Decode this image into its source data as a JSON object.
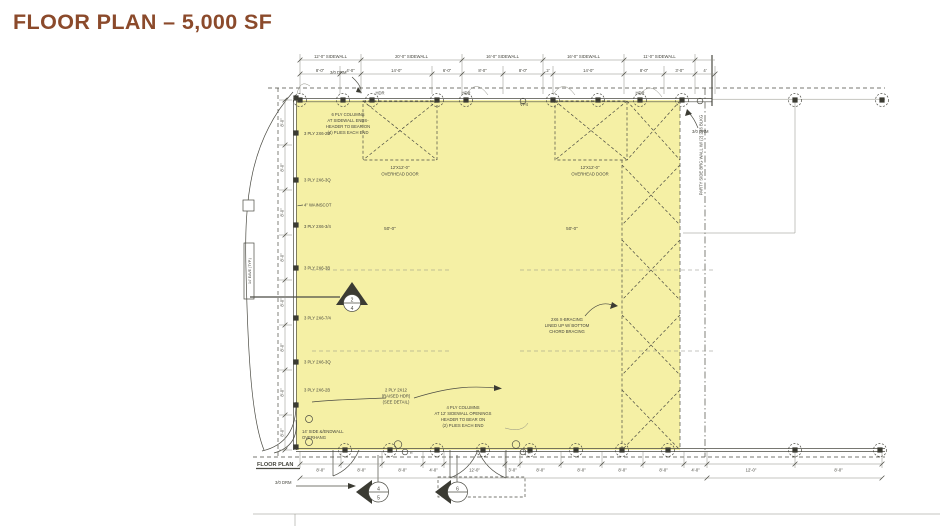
{
  "title": "FLOOR PLAN – 5,000 SF",
  "colors": {
    "highlight": "#F4EF9D",
    "line": "#4B4B43",
    "title_brown": "#8B4A2B"
  },
  "plan": {
    "sheet_label": "FLOOR PLAN",
    "top_dims_upper": [
      "12'-0\" SIDEWALL",
      "20'-0\" SIDEWALL",
      "16'-0\" SIDEWALL",
      "16'-0\" SIDEWALL",
      "11'-0\" SIDEWALL"
    ],
    "top_dims": [
      "8'-0\"",
      "4'-0\"",
      "14'-0\"",
      "6'-0\"",
      "8'-0\"",
      "8'-0\"",
      "2'",
      "14'-0\"",
      "8'-0\"",
      "3'-0\"",
      "4'"
    ],
    "bottom_dims": [
      "8'-0\"",
      "8'-0\"",
      "8'-0\"",
      "4'-0\"",
      "12'-0\"",
      "3'-0\"",
      "8'-0\"",
      "8'-0\"",
      "8'-0\"",
      "8'-0\"",
      "4'-0\"",
      "12'-0\"",
      "8'-0\""
    ],
    "left_dims": [
      "8'-0\"",
      "8'-0\"",
      "8'-0\"",
      "8'-0\"",
      "8'-0\"",
      "8'-0\"",
      "8'-0\"",
      "8'-0\""
    ],
    "bay_labels": [
      "50'-0\"",
      "50'-0\""
    ],
    "overhead_door_1": {
      "size": "12'X12'-0\"",
      "label": "OVERHEAD DOOR"
    },
    "overhead_door_2": {
      "size": "12'X12'-0\"",
      "label": "OVERHEAD DOOR"
    },
    "column_callouts": [
      "3 PLY 2X6-2B",
      "3 PLY 2X6-3Q",
      "4\" WAINSCOT",
      "3 PLY 2X6-3/4",
      "3 PLY 2X6-3B",
      "3 PLY 2X6-7/4",
      "3 PLY 2X6-3Q",
      "3 PLY 2X6-2B"
    ],
    "notes": {
      "six_ply": [
        "6 PLY COLUMNS",
        "AT SIDEWALL ENDS-",
        "HEADER TO BEAR ON",
        "(4) PLIES EACH END"
      ],
      "bracing": [
        "2X6 X-BRACING",
        "LINED UP W/ BOTTOM",
        "CHORD BRACING"
      ],
      "raised_hdr": [
        "2 PLY 2X12",
        "(RAISED HDR)",
        "(SEE DETAIL)"
      ],
      "four_ply": [
        "4 PLY COLUMNS",
        "AT 12' SIDEWALL OPENINGS",
        "HEADER TO BEAR ON",
        "(2) PLIES EACH END"
      ],
      "overhang": [
        "14' SIDE &/ENDWALL",
        "OVERHANG"
      ]
    },
    "wall_labels": {
      "hdr1": "HDR",
      "hdr2": "HDR",
      "hdr3": "HDR",
      "vp": "VP4",
      "door_top": "3/0 DRM",
      "door_right": "3/0 DRM",
      "door_bottom": "3/0 DRM"
    },
    "side_labels": {
      "party": "PARTY SIDE BRG WALL W/ (2) 2X6 BLKG",
      "eave": "14' EAVE (TYP.)"
    },
    "markers": {
      "a_top": "2",
      "a_bottom": "4",
      "b_top": "4",
      "b_bottom": "5",
      "c_top": "6",
      "c_bottom": ""
    },
    "r_label": "R"
  }
}
